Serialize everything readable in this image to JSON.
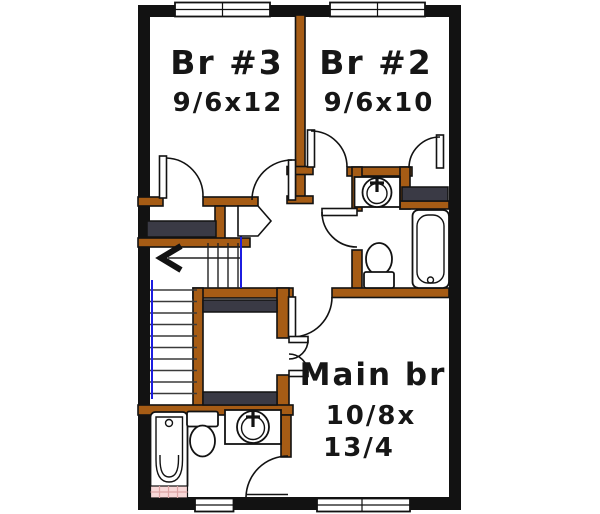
{
  "rooms": {
    "br3": {
      "label": "Br #3",
      "dimensions": "9/6x12"
    },
    "br2": {
      "label": "Br #2",
      "dimensions": "9/6x10"
    },
    "main": {
      "label": "Main br",
      "dimensions_line1": "10/8x",
      "dimensions_line2": "13/4"
    }
  },
  "fixtures": {
    "upper_bathroom": [
      "vanity-sink",
      "toilet",
      "bathtub"
    ],
    "lower_bathroom": [
      "vanity-sink",
      "toilet",
      "bathtub",
      "pink-tile-floor"
    ],
    "closets": [
      "br3-closet-shelf",
      "br2-closet-shelf",
      "main-walkin-closet-shelves"
    ],
    "stairs": {
      "direction_arrow": "left"
    },
    "windows": [
      "top-double-br3",
      "top-double-br2",
      "bottom-single-bath",
      "bottom-double-main"
    ]
  },
  "colors": {
    "wall_black": "#121212",
    "interior_wall_brown": "#a65c15",
    "closet_shelf_dark": "#3a3a45",
    "stair_accent_blue": "#1c1ce0",
    "tile_pink": "#f8d8d8"
  }
}
